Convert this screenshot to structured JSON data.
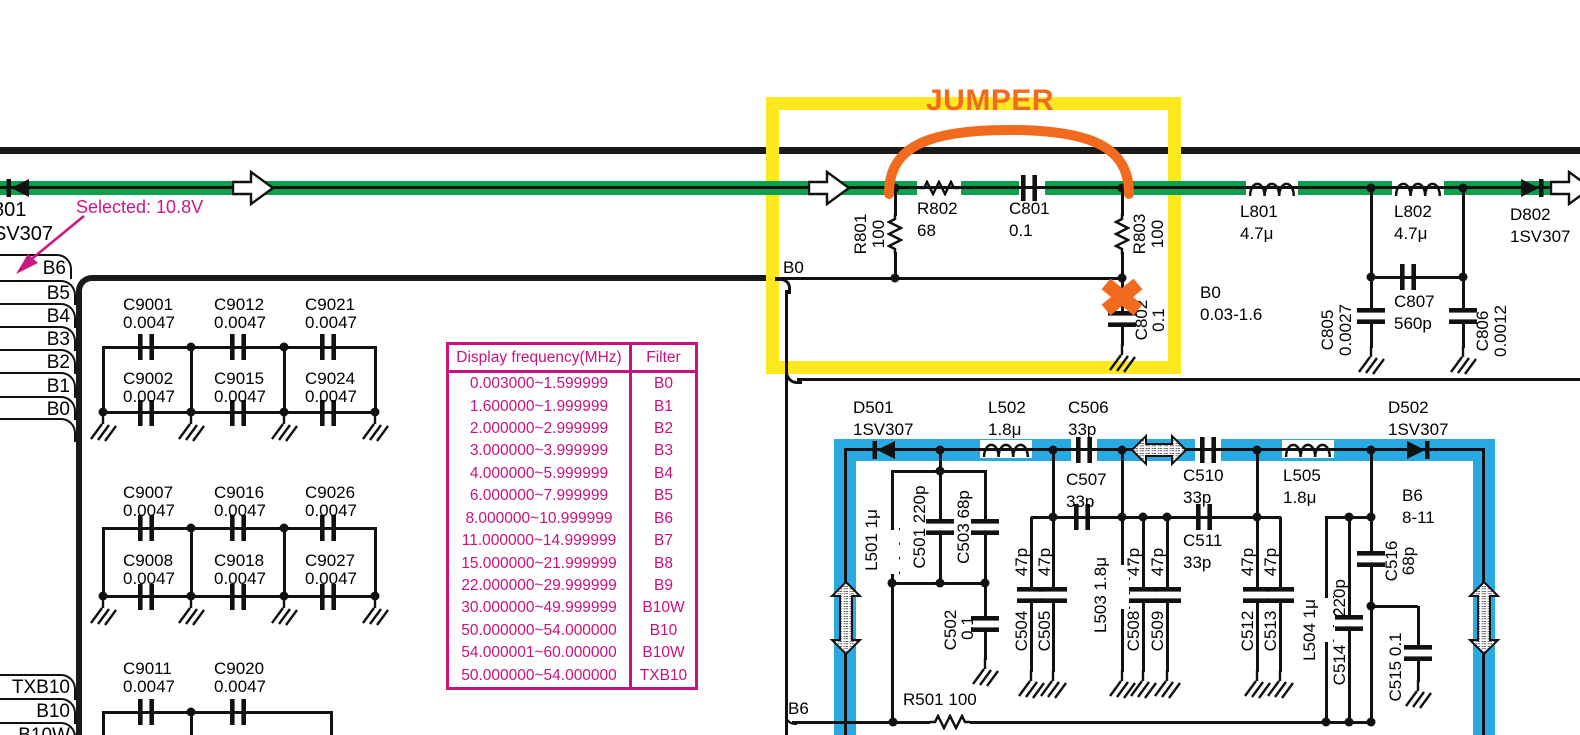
{
  "annotations": {
    "jumper": "JUMPER",
    "selected_note": "Selected: 10.8V",
    "colors": {
      "green": "#0ca04e",
      "blue": "#29a9e1",
      "magenta": "#cb1784",
      "yellow": "#ffe81e",
      "orange": "#f26a1d"
    }
  },
  "upper": {
    "d801": [
      "801",
      "SV307"
    ],
    "b0_wire": "B0",
    "r801": [
      "R801",
      "100"
    ],
    "r802": [
      "R802",
      "68"
    ],
    "c801": [
      "C801",
      "0.1"
    ],
    "r803": [
      "R803",
      "100"
    ],
    "c802": [
      "C802",
      "0.1"
    ],
    "l801": [
      "L801",
      "4.7μ"
    ],
    "l802": [
      "L802",
      "4.7μ"
    ],
    "d802": [
      "D802",
      "1SV307"
    ],
    "b0_range": [
      "B0",
      "0.03-1.6"
    ],
    "c805": [
      "C805",
      "0.0027"
    ],
    "c807": [
      "C807",
      "560p"
    ],
    "c806": [
      "C806",
      "0.0012"
    ]
  },
  "left": {
    "tabs": [
      "B6",
      "B5",
      "B4",
      "B3",
      "B2",
      "B1",
      "B0"
    ],
    "tabs_bottom": [
      "TXB10",
      "B10",
      "B10W"
    ],
    "caps": {
      "c9001": [
        "C9001",
        "0.0047"
      ],
      "c9012": [
        "C9012",
        "0.0047"
      ],
      "c9021": [
        "C9021",
        "0.0047"
      ],
      "c9002": [
        "C9002",
        "0.0047"
      ],
      "c9015": [
        "C9015",
        "0.0047"
      ],
      "c9024": [
        "C9024",
        "0.0047"
      ],
      "c9007": [
        "C9007",
        "0.0047"
      ],
      "c9016": [
        "C9016",
        "0.0047"
      ],
      "c9026": [
        "C9026",
        "0.0047"
      ],
      "c9008": [
        "C9008",
        "0.0047"
      ],
      "c9018": [
        "C9018",
        "0.0047"
      ],
      "c9027": [
        "C9027",
        "0.0047"
      ],
      "c9011": [
        "C9011",
        "0.0047"
      ],
      "c9020": [
        "C9020",
        "0.0047"
      ]
    }
  },
  "table": {
    "headers": [
      "Display frequency(MHz)",
      "Filter"
    ],
    "rows": [
      [
        "0.003000~1.599999",
        "B0"
      ],
      [
        "1.600000~1.999999",
        "B1"
      ],
      [
        "2.000000~2.999999",
        "B2"
      ],
      [
        "3.000000~3.999999",
        "B3"
      ],
      [
        "4.000000~5.999999",
        "B4"
      ],
      [
        "6.000000~7.999999",
        "B5"
      ],
      [
        "8.000000~10.999999",
        "B6"
      ],
      [
        "11.000000~14.999999",
        "B7"
      ],
      [
        "15.000000~21.999999",
        "B8"
      ],
      [
        "22.000000~29.999999",
        "B9"
      ],
      [
        "30.000000~49.999999",
        "B10W"
      ],
      [
        "50.000000~54.000000",
        "B10"
      ],
      [
        "54.000001~60.000000",
        "B10W"
      ],
      [
        "50.000000~54.000000",
        "TXB10"
      ]
    ]
  },
  "lower": {
    "b6_wire": "B6",
    "d501": [
      "D501",
      "1SV307"
    ],
    "l502": [
      "L502",
      "1.8μ"
    ],
    "c506": [
      "C506",
      "33p"
    ],
    "c507": [
      "C507",
      "33p"
    ],
    "c510": [
      "C510",
      "33p"
    ],
    "c511": [
      "C511",
      "33p"
    ],
    "l505": [
      "L505",
      "1.8μ"
    ],
    "d502": [
      "D502",
      "1SV307"
    ],
    "b6_range": [
      "B6",
      "8-11"
    ],
    "l501": "L501 1μ",
    "c501": "C501 220p",
    "c503": "C503 68p",
    "c502": [
      "C502",
      "0.1"
    ],
    "c504": [
      "C504",
      "47p"
    ],
    "c505": [
      "C505",
      "47p"
    ],
    "l503": "L503 1.8μ",
    "c508": [
      "C508",
      "47p"
    ],
    "c509": [
      "C509",
      "47p"
    ],
    "c512": [
      "C512",
      "47p"
    ],
    "c513": [
      "C513",
      "47p"
    ],
    "l504": "L504 1μ",
    "c514": [
      "C514",
      "220p"
    ],
    "c516": [
      "C516",
      "68p"
    ],
    "c515": "C515 0.1",
    "r501": "R501 100"
  }
}
